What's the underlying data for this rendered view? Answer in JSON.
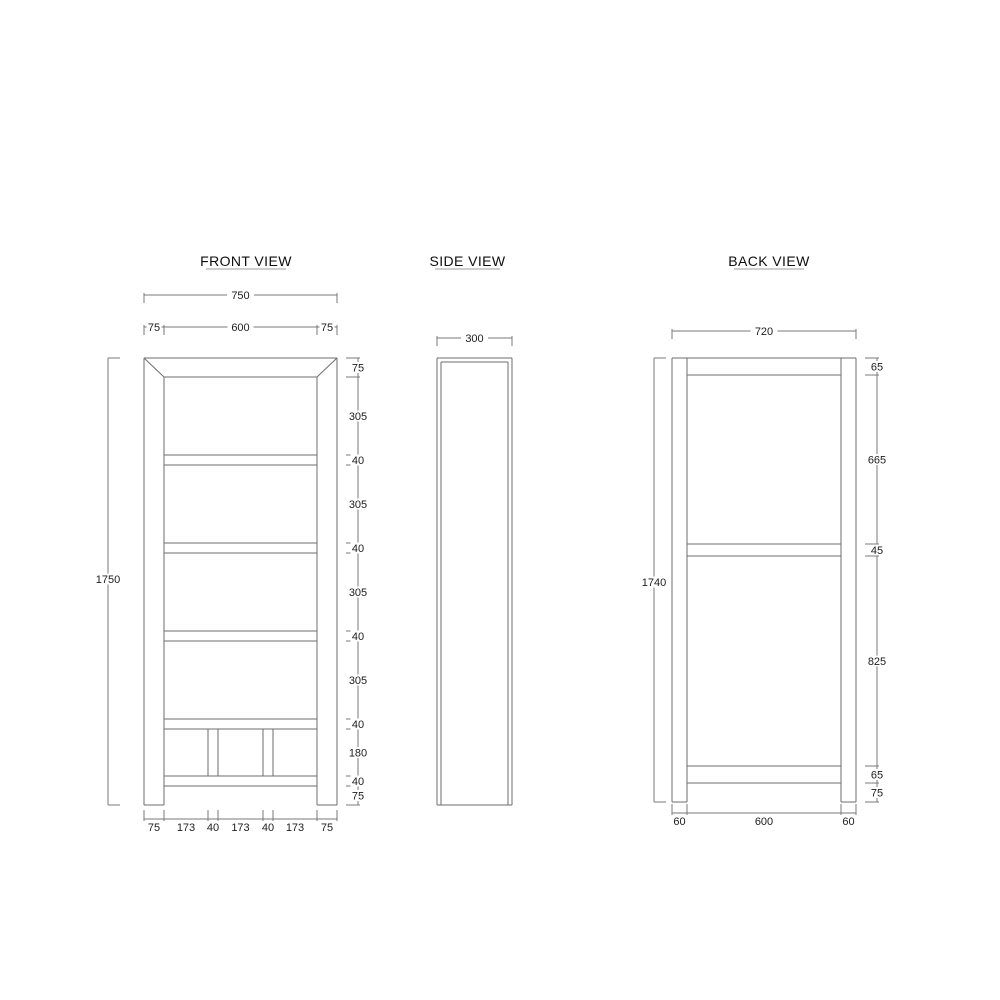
{
  "drawing": {
    "background_color": "#ffffff",
    "line_color": "#6e6e6e",
    "text_color": "#1d1d1d",
    "views": {
      "front": {
        "title": "FRONT VIEW",
        "dims": {
          "overall_width": "750",
          "top_chain": [
            "75",
            "600",
            "75"
          ],
          "overall_height": "1750",
          "right_chain": [
            "75",
            "305",
            "40",
            "305",
            "40",
            "305",
            "40",
            "305",
            "40",
            "180",
            "40",
            "75"
          ],
          "bottom_chain": [
            "75",
            "173",
            "40",
            "173",
            "40",
            "173",
            "75"
          ]
        }
      },
      "side": {
        "title": "SIDE VIEW",
        "dims": {
          "depth": "300"
        }
      },
      "back": {
        "title": "BACK VIEW",
        "dims": {
          "overall_width": "720",
          "overall_height": "1740",
          "right_chain": [
            "65",
            "665",
            "45",
            "825",
            "65",
            "75"
          ],
          "bottom_chain": [
            "60",
            "600",
            "60"
          ]
        }
      }
    }
  }
}
